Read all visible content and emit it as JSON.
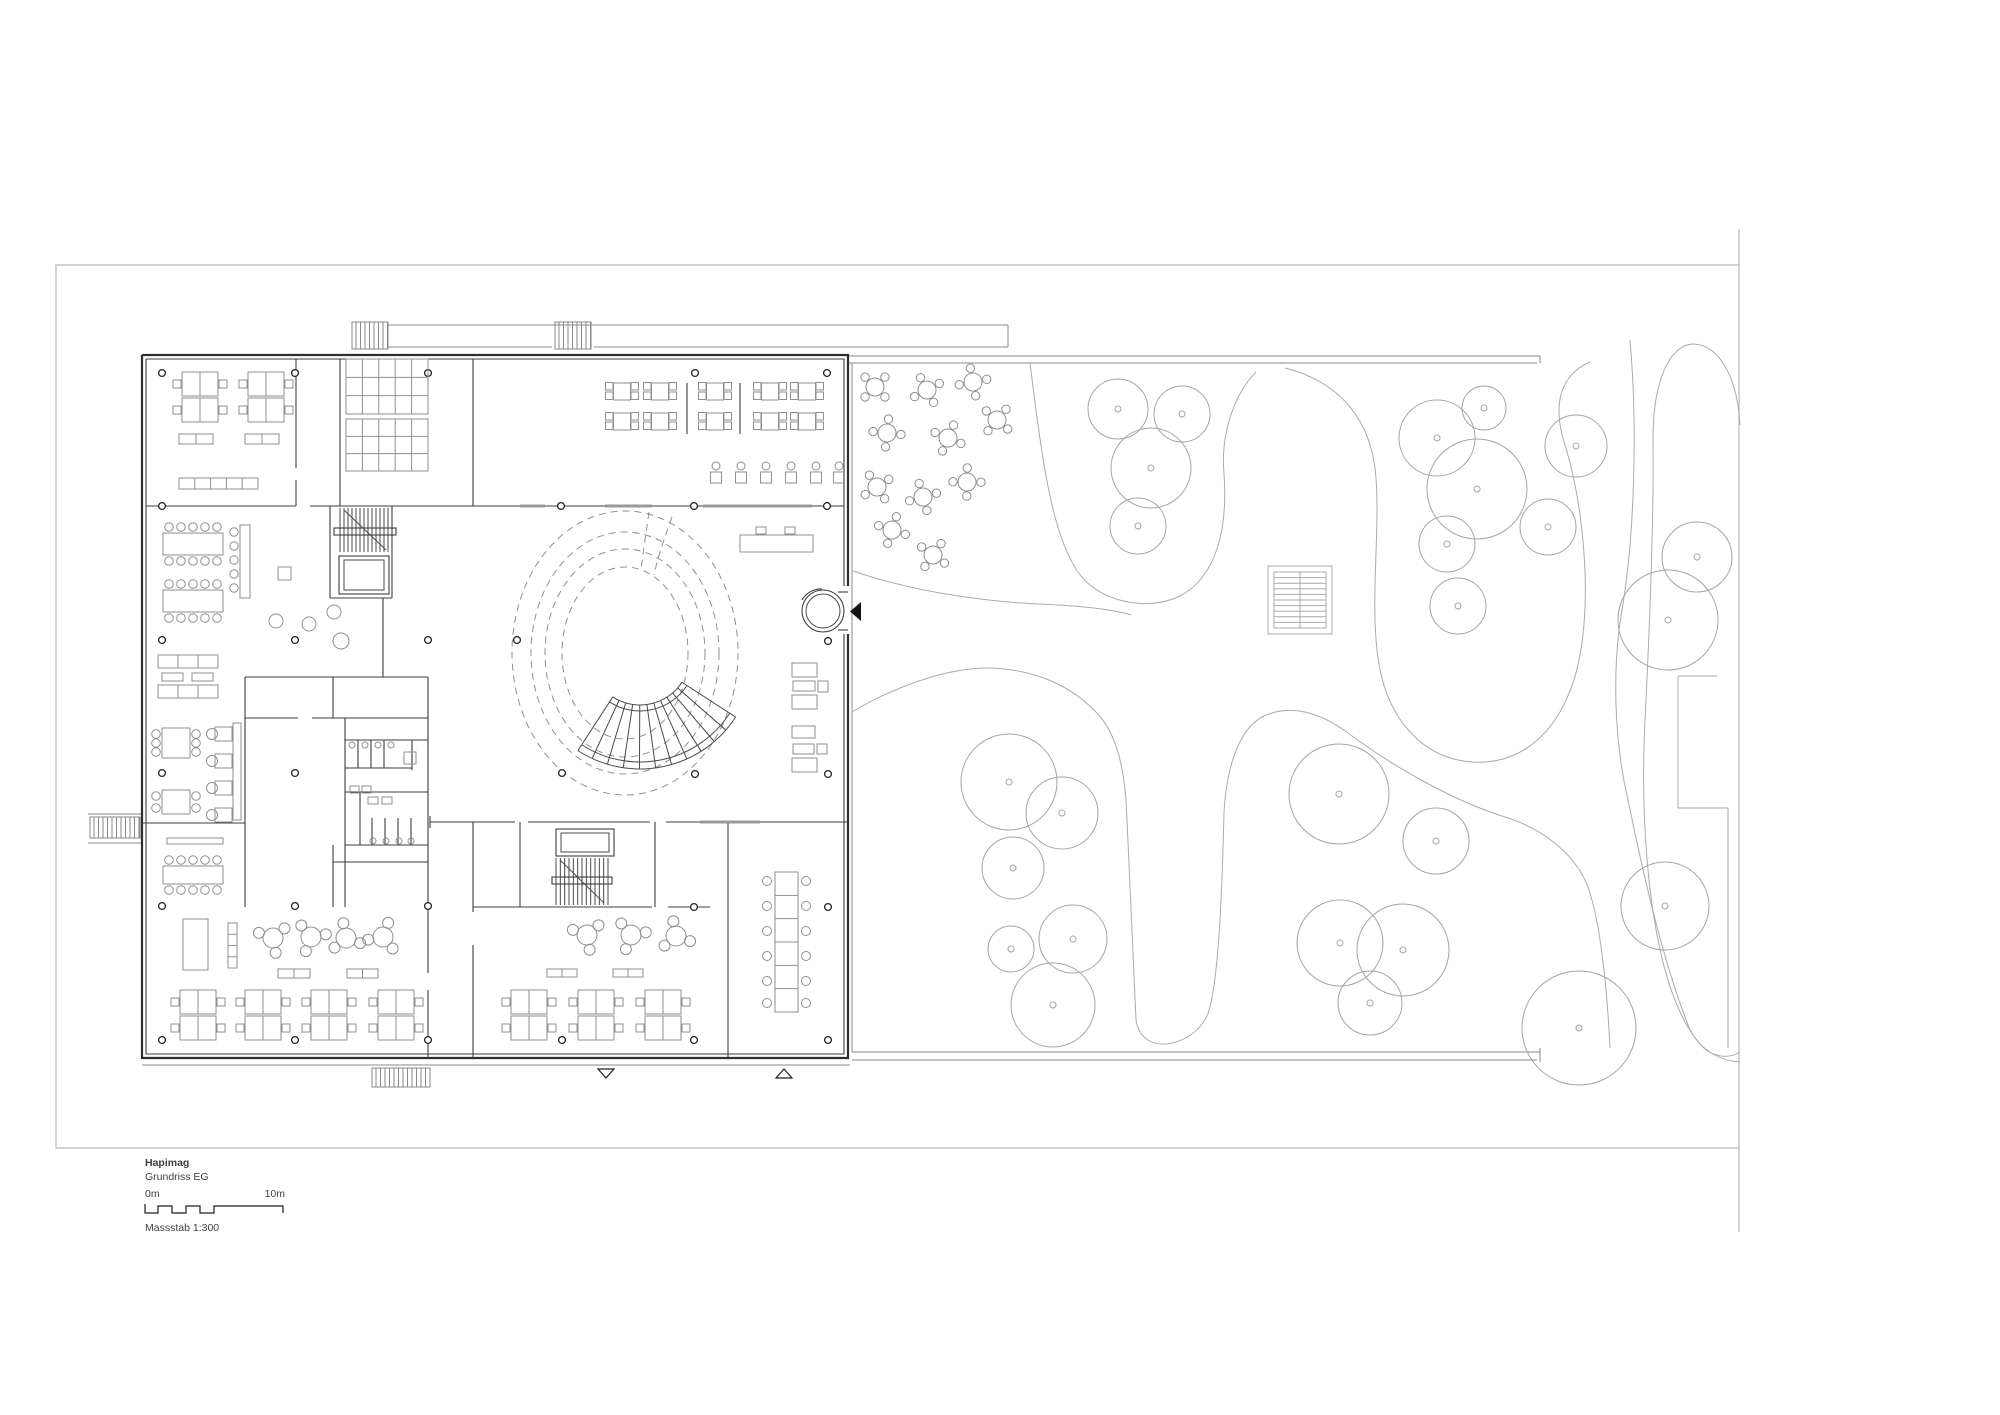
{
  "title_block": {
    "project": "Hapimag",
    "drawing": "Grundriss EG",
    "scale_start": "0m",
    "scale_end": "10m",
    "scale_label": "Massstab 1:300",
    "scalebar_path": "M145,1204 L145,1213 L158,1213 L158,1206 L172,1206 L172,1213 L186,1213 L186,1206 L200,1206 L200,1213 L214,1213 L214,1206 L283,1206 L283,1213"
  },
  "colors": {
    "wall": "#2e2e2e",
    "furniture": "#8f8f8f",
    "garden": "#ababab",
    "frame": "#b8b8b8"
  },
  "plan": {
    "frame": {
      "rect": [
        56,
        265,
        1683,
        883
      ],
      "ticks": [
        [
          1739,
          229,
          1739,
          265
        ],
        [
          1739,
          1148,
          1739,
          1232
        ]
      ]
    },
    "walls_thick": [
      "M142,355 H848 V586",
      "M848,634 V1058 H142 V355"
    ],
    "walls_thin": [
      "M146,359 H844 V586",
      "M844,634 V1054 H146 V359",
      "M296,359 V468",
      "M296,480 V506",
      "M340,359 V506",
      "M473,359 V506",
      "M146,506 H296",
      "M310,506 H844",
      "M330,506 V598",
      "M392,506 V598",
      "M330,598 H392",
      "M383,598 V677",
      "M245,677 H428",
      "M245,677 V907",
      "M428,677 V907",
      "M333,677 V718",
      "M245,718 H298",
      "M312,718 H428",
      "M345,718 V907",
      "M345,740 H428",
      "M358,740 V768",
      "M371,740 V768",
      "M384,740 V768",
      "M412,740 V770",
      "M345,768 H412",
      "M345,792 H428",
      "M360,792 V845",
      "M345,845 H428",
      "M372,818 V845",
      "M385,818 V845",
      "M398,818 V845",
      "M411,818 V845",
      "M333,845 V907",
      "M333,862 H428",
      "M430,822 H515",
      "M528,822 H650",
      "M666,822 H848",
      "M430,816 V828",
      "M520,822 V907",
      "M655,822 V907",
      "M473,822 V912",
      "M473,945 V1058",
      "M473,907 H652",
      "M668,907 H710",
      "M428,907 V973",
      "M428,990 V1058",
      "M728,822 V1058",
      "M142,823 H245",
      "M838,592 H848",
      "M838,630 H848"
    ],
    "glazing": [
      [
        520,
        506,
        545
      ],
      [
        605,
        506,
        652
      ],
      [
        703,
        506,
        812
      ],
      [
        700,
        822,
        760
      ]
    ],
    "exterior_lines": [
      "M848,356 H1540",
      "M848,363 H1537",
      "M1540,356 V363",
      "M388,325 H1008",
      "M1008,325 V347",
      "M388,347 H552",
      "M594,347 H1008",
      "M88,814 H142",
      "M88,843 H142",
      "M142,1065 H850",
      "M852,1052 H1540",
      "M852,1060 H1537",
      "M1540,1048 V1062",
      "M852,363 V1052"
    ],
    "hatch_rects": [
      [
        352,
        322,
        36,
        27
      ],
      [
        555,
        322,
        36,
        27
      ],
      [
        90,
        817,
        50,
        21
      ],
      [
        372,
        1068,
        58,
        19
      ]
    ],
    "cores": [
      {
        "hatch": [
          340,
          508,
          48,
          44,
          12
        ],
        "elev": [
          339,
          556,
          50,
          38
        ],
        "landing": [
          334,
          528,
          62,
          7
        ],
        "diag": [
          344,
          510,
          386,
          550
        ]
      },
      {
        "hatch": [
          556,
          858,
          52,
          47,
          12
        ],
        "elev": [
          556,
          829,
          58,
          27
        ],
        "landing": [
          552,
          877,
          60,
          7
        ],
        "diag": [
          560,
          860,
          604,
          903
        ]
      }
    ],
    "columns": [
      [
        162,
        373
      ],
      [
        295,
        373
      ],
      [
        428,
        373
      ],
      [
        695,
        373
      ],
      [
        827,
        373
      ],
      [
        162,
        506
      ],
      [
        561,
        506
      ],
      [
        694,
        506
      ],
      [
        827,
        506
      ],
      [
        162,
        640
      ],
      [
        295,
        640
      ],
      [
        428,
        640
      ],
      [
        517,
        640
      ],
      [
        828,
        641
      ],
      [
        162,
        773
      ],
      [
        295,
        773
      ],
      [
        562,
        773
      ],
      [
        695,
        774
      ],
      [
        828,
        774
      ],
      [
        162,
        906
      ],
      [
        295,
        906
      ],
      [
        428,
        906
      ],
      [
        694,
        907
      ],
      [
        828,
        907
      ],
      [
        162,
        1040
      ],
      [
        295,
        1040
      ],
      [
        428,
        1040
      ],
      [
        562,
        1040
      ],
      [
        694,
        1040
      ],
      [
        828,
        1040
      ]
    ],
    "courtyard": {
      "cx": 625,
      "cy": 653,
      "rings": [
        [
          113,
          142
        ],
        [
          94,
          121
        ],
        [
          80,
          104
        ],
        [
          63,
          86
        ]
      ],
      "wedge": [
        "M649,512 C646,534 643,552 641,570",
        "M672,517 C664,540 658,556 654,575"
      ],
      "fan": {
        "cx": 640,
        "cy": 655,
        "ri": 50,
        "ro": 114,
        "a1": 33,
        "a2": 123,
        "treads": 11
      }
    },
    "revolving_door": {
      "cx": 823,
      "cy": 611,
      "r1": 21,
      "r2": 17,
      "arc": "M802,600 A22,22 0 0 1 822,589"
    },
    "entry_arrow": "M861,602 L850,611.5 L861,621 Z",
    "section_triangles": [
      "M598,1069 L614,1069 L606,1078 Z",
      "M776,1078 L792,1078 L784,1069 Z"
    ],
    "furniture": {
      "desk_clusters": [
        [
          200,
          397
        ],
        [
          266,
          397
        ],
        [
          198,
          1015
        ],
        [
          263,
          1015
        ],
        [
          329,
          1015
        ],
        [
          396,
          1015
        ],
        [
          529,
          1015
        ],
        [
          596,
          1015
        ],
        [
          663,
          1015
        ]
      ],
      "kitchen_grids": [
        [
          346,
          359,
          82,
          55,
          5,
          3
        ],
        [
          346,
          419,
          82,
          52,
          5,
          3
        ]
      ],
      "canteen": {
        "rows": [
          383,
          413
        ],
        "unit_cx": [
          622,
          660,
          715,
          770,
          807
        ],
        "table": 17,
        "bars": [
          687,
          740
        ],
        "bar_y": [
          383,
          434
        ]
      },
      "stools": {
        "y": 472,
        "cx": [
          716,
          741,
          766,
          791,
          816,
          839
        ]
      },
      "long_tables": [
        [
          163,
          533,
          60,
          22,
          5
        ],
        [
          163,
          590,
          60,
          22,
          5
        ],
        [
          163,
          866,
          60,
          18,
          5
        ]
      ],
      "dining_tables": [
        [
          162,
          728,
          28,
          30,
          3
        ],
        [
          162,
          790,
          28,
          24,
          2
        ]
      ],
      "conference": {
        "x": 775,
        "y": 872,
        "w": 23,
        "h": 140,
        "segs": 5,
        "chairs": [
          881,
          906,
          931,
          956,
          981,
          1003
        ]
      },
      "round_clusters": [
        [
          273,
          938
        ],
        [
          311,
          937
        ],
        [
          346,
          938
        ],
        [
          383,
          937
        ],
        [
          587,
          935
        ],
        [
          631,
          935
        ],
        [
          676,
          936
        ]
      ],
      "sofas": [
        [
          158,
          655,
          60,
          13,
          3
        ],
        [
          158,
          685,
          60,
          13,
          3
        ]
      ],
      "lounge_tables": [
        [
          162,
          673,
          21,
          8
        ],
        [
          192,
          673,
          21,
          8
        ]
      ],
      "armchairs": {
        "x": 215,
        "ys": [
          727,
          754,
          781,
          808
        ]
      },
      "band": [
        233,
        723,
        8,
        97
      ],
      "banquette": {
        "rect": [
          240,
          525,
          10,
          73
        ],
        "stool_x": 234,
        "stool_ys": [
          532,
          546,
          560,
          574,
          588
        ]
      },
      "small_square": [
        278,
        567,
        13,
        13
      ],
      "poufs": [
        [
          276,
          621,
          7
        ],
        [
          309,
          624,
          7
        ],
        [
          334,
          612,
          7
        ],
        [
          341,
          641,
          8
        ]
      ],
      "cabinets": [
        [
          183,
          919,
          25,
          51
        ]
      ],
      "shelf": [
        228,
        923,
        9,
        45
      ],
      "sideboards": [
        [
          179,
          434,
          34,
          10,
          2
        ],
        [
          245,
          434,
          34,
          10,
          2
        ],
        [
          179,
          478,
          79,
          11,
          5
        ],
        [
          278,
          969,
          32,
          9,
          2
        ],
        [
          347,
          969,
          31,
          9,
          2
        ],
        [
          547,
          969,
          30,
          8,
          2
        ],
        [
          613,
          969,
          30,
          8,
          2
        ]
      ],
      "whiteboard": [
        167,
        838,
        56,
        6
      ],
      "reception": {
        "desk": [
          740,
          535,
          73,
          17
        ],
        "chairs": [
          [
            756,
            527,
            10,
            7
          ],
          [
            785,
            527,
            10,
            7
          ]
        ]
      },
      "lobby_rects": [
        [
          792,
          663,
          25,
          14
        ],
        [
          793,
          681,
          22,
          10
        ],
        [
          818,
          681,
          10,
          11
        ],
        [
          792,
          695,
          25,
          14
        ],
        [
          792,
          726,
          23,
          12
        ],
        [
          793,
          744,
          21,
          10
        ],
        [
          817,
          744,
          10,
          10
        ],
        [
          792,
          758,
          25,
          14
        ]
      ],
      "wc_circles": [
        [
          352,
          745
        ],
        [
          365,
          745
        ],
        [
          378,
          745
        ],
        [
          391,
          745
        ],
        [
          373,
          841
        ],
        [
          386,
          841
        ],
        [
          399,
          841
        ],
        [
          411,
          841
        ]
      ],
      "wc_rects": [
        [
          350,
          786,
          9,
          7
        ],
        [
          362,
          786,
          9,
          7
        ],
        [
          368,
          797,
          10,
          7
        ],
        [
          382,
          797,
          10,
          7
        ],
        [
          404,
          752,
          12,
          12
        ]
      ]
    },
    "garden": {
      "paths": [
        "M1030,363 C1042,460 1052,535 1078,572 C1098,602 1148,612 1180,596 C1216,577 1228,530 1224,474 C1220,428 1238,390 1256,372",
        "M853,571 C920,594 995,602 1038,604 C1085,606 1115,610 1131,615",
        "M852,712 C892,688 945,668 988,668 C1038,669 1072,688 1094,710 C1115,730 1123,762 1126,800 C1130,878 1133,958 1136,1020 C1139,1040 1155,1047 1172,1043 C1189,1039 1199,1030 1206,1018 C1218,995 1222,898 1224,812 C1227,762 1241,727 1264,716 C1290,704 1320,712 1348,733 C1392,766 1452,800 1502,816 C1542,828 1572,852 1586,882 C1600,916 1607,986 1610,1048",
        "M1285,368 C1340,382 1372,420 1376,478 C1380,535 1370,600 1378,658 C1386,716 1420,758 1472,762 C1528,766 1568,722 1580,655 C1592,588 1582,500 1565,445 C1552,405 1560,375 1590,362",
        "M1630,340 C1638,430 1634,540 1622,610 C1612,668 1614,740 1628,800 C1642,868 1662,960 1690,1030 C1702,1052 1722,1061 1740,1062",
        "M1740,425 C1737,372 1716,344 1693,344 C1668,345 1652,385 1653,445 C1654,530 1649,640 1645,720 C1641,800 1646,880 1658,940 C1668,990 1684,1030 1706,1050 C1718,1058 1730,1058 1740,1052",
        "M1678,676 H1717",
        "M1678,676 V808",
        "M1678,808 H1728",
        "M1728,808 V1048"
      ],
      "trees": [
        [
          1118,
          409,
          30
        ],
        [
          1182,
          414,
          28
        ],
        [
          1151,
          468,
          40
        ],
        [
          1138,
          526,
          28
        ],
        [
          1484,
          408,
          22
        ],
        [
          1437,
          438,
          38
        ],
        [
          1477,
          489,
          50
        ],
        [
          1447,
          544,
          28
        ],
        [
          1458,
          606,
          28
        ],
        [
          1576,
          446,
          31
        ],
        [
          1548,
          527,
          28
        ],
        [
          1697,
          557,
          35
        ],
        [
          1668,
          620,
          50
        ],
        [
          1009,
          782,
          48
        ],
        [
          1062,
          813,
          36
        ],
        [
          1013,
          868,
          31
        ],
        [
          1011,
          949,
          23
        ],
        [
          1073,
          939,
          34
        ],
        [
          1053,
          1005,
          42
        ],
        [
          1339,
          794,
          50
        ],
        [
          1436,
          841,
          33
        ],
        [
          1340,
          943,
          43
        ],
        [
          1403,
          950,
          46
        ],
        [
          1370,
          1003,
          32
        ],
        [
          1579,
          1028,
          57
        ],
        [
          1665,
          906,
          44
        ]
      ],
      "cafe_tables": [
        [
          875,
          387
        ],
        [
          927,
          390
        ],
        [
          973,
          382
        ],
        [
          887,
          433
        ],
        [
          948,
          438
        ],
        [
          997,
          420
        ],
        [
          877,
          487
        ],
        [
          923,
          497
        ],
        [
          967,
          482
        ],
        [
          892,
          530
        ],
        [
          933,
          555
        ]
      ],
      "slat": {
        "outer": [
          1268,
          566,
          64,
          68
        ],
        "inner": [
          1274,
          572,
          52,
          56
        ],
        "lines": 9
      }
    }
  }
}
